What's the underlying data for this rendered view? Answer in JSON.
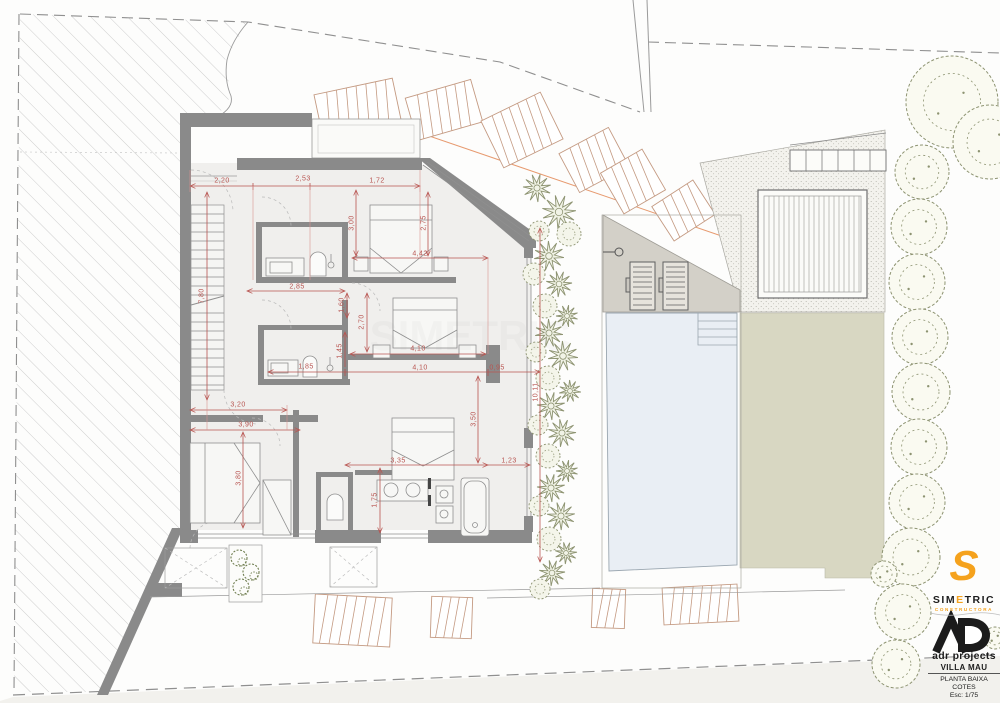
{
  "title_block": {
    "simetric": {
      "logo_letter": "S",
      "p1": "SIM",
      "p2": "E",
      "p3": "TRIC",
      "subtitle": "CONSTRUCTORA"
    },
    "adr": {
      "monogram": "AD",
      "name": "adr projects"
    },
    "project": "VILLA MAU",
    "sheet_line1": "PLANTA BAIXA",
    "sheet_line2": "COTES",
    "scale": "Esc: 1/75"
  },
  "colors": {
    "dimension_red": "#b85450",
    "wall_gray": "#8a8a8a",
    "floor": "#f0efed",
    "tree_olive": "#8d9371",
    "lawn": "#d8d7c2",
    "pool": "#e9eef4",
    "terrace": "#d3d0c8",
    "street_tan": "#c49a82",
    "accent_orange": "#f5a21d",
    "boundary_gray": "#8f8f8f"
  },
  "dimensions": [
    {
      "text": "2,20",
      "x": 222,
      "y": 181,
      "rot": 0
    },
    {
      "text": "2,53",
      "x": 303,
      "y": 179,
      "rot": 0
    },
    {
      "text": "1,72",
      "x": 377,
      "y": 181,
      "rot": 0
    },
    {
      "text": "3,00",
      "x": 352,
      "y": 223,
      "rot": 90
    },
    {
      "text": "2,75",
      "x": 424,
      "y": 223,
      "rot": 90
    },
    {
      "text": "4,42",
      "x": 420,
      "y": 254,
      "rot": 0
    },
    {
      "text": "2,85",
      "x": 297,
      "y": 287,
      "rot": 0
    },
    {
      "text": "7,80",
      "x": 202,
      "y": 296,
      "rot": 90
    },
    {
      "text": "1,60",
      "x": 342,
      "y": 305,
      "rot": 90
    },
    {
      "text": "2,70",
      "x": 362,
      "y": 322,
      "rot": 90
    },
    {
      "text": "1,45",
      "x": 340,
      "y": 351,
      "rot": 90
    },
    {
      "text": "4,10",
      "x": 418,
      "y": 349,
      "rot": 0
    },
    {
      "text": "1,85",
      "x": 306,
      "y": 367,
      "rot": 0
    },
    {
      "text": "4,10",
      "x": 420,
      "y": 368,
      "rot": 0
    },
    {
      "text": "0,95",
      "x": 497,
      "y": 368,
      "rot": 0
    },
    {
      "text": "3,20",
      "x": 238,
      "y": 405,
      "rot": 0
    },
    {
      "text": "3,90",
      "x": 246,
      "y": 425,
      "rot": 0
    },
    {
      "text": "3,50",
      "x": 474,
      "y": 419,
      "rot": 90
    },
    {
      "text": "3,80",
      "x": 239,
      "y": 478,
      "rot": 90
    },
    {
      "text": "3,35",
      "x": 398,
      "y": 461,
      "rot": 0
    },
    {
      "text": "1,23",
      "x": 509,
      "y": 461,
      "rot": 0
    },
    {
      "text": "1,75",
      "x": 375,
      "y": 500,
      "rot": 90
    },
    {
      "text": "10,11",
      "x": 536,
      "y": 392,
      "rot": 90
    }
  ],
  "landscape": {
    "row_trees": [
      [
        952,
        102,
        46
      ],
      [
        990,
        142,
        37
      ],
      [
        922,
        172,
        27
      ],
      [
        919,
        227,
        28
      ],
      [
        917,
        282,
        28
      ],
      [
        920,
        337,
        28
      ],
      [
        921,
        392,
        29
      ],
      [
        919,
        447,
        28
      ],
      [
        917,
        502,
        28
      ],
      [
        911,
        557,
        29
      ],
      [
        903,
        612,
        28
      ],
      [
        896,
        664,
        24
      ],
      [
        884,
        574,
        13
      ],
      [
        995,
        638,
        11
      ]
    ],
    "strip_plants": [
      [
        537,
        188,
        14,
        "p"
      ],
      [
        559,
        212,
        17,
        "p"
      ],
      [
        539,
        231,
        10,
        "s"
      ],
      [
        569,
        234,
        12,
        "s"
      ],
      [
        549,
        256,
        15,
        "p"
      ],
      [
        534,
        274,
        11,
        "s"
      ],
      [
        559,
        284,
        13,
        "p"
      ],
      [
        545,
        306,
        12,
        "s"
      ],
      [
        567,
        316,
        11,
        "p"
      ],
      [
        549,
        333,
        14,
        "p"
      ],
      [
        536,
        352,
        10,
        "s"
      ],
      [
        563,
        356,
        15,
        "p"
      ],
      [
        548,
        378,
        12,
        "s"
      ],
      [
        570,
        391,
        11,
        "p"
      ],
      [
        551,
        406,
        14,
        "p"
      ],
      [
        538,
        425,
        10,
        "s"
      ],
      [
        562,
        433,
        14,
        "p"
      ],
      [
        548,
        456,
        12,
        "s"
      ],
      [
        567,
        471,
        11,
        "p"
      ],
      [
        551,
        488,
        14,
        "p"
      ],
      [
        539,
        506,
        10,
        "s"
      ],
      [
        561,
        516,
        14,
        "p"
      ],
      [
        549,
        539,
        12,
        "s"
      ],
      [
        566,
        553,
        11,
        "p"
      ],
      [
        552,
        573,
        13,
        "p"
      ],
      [
        540,
        589,
        10,
        "s"
      ]
    ],
    "planter_plants": [
      [
        239,
        558,
        8
      ],
      [
        251,
        572,
        8
      ],
      [
        241,
        587,
        8
      ]
    ]
  }
}
